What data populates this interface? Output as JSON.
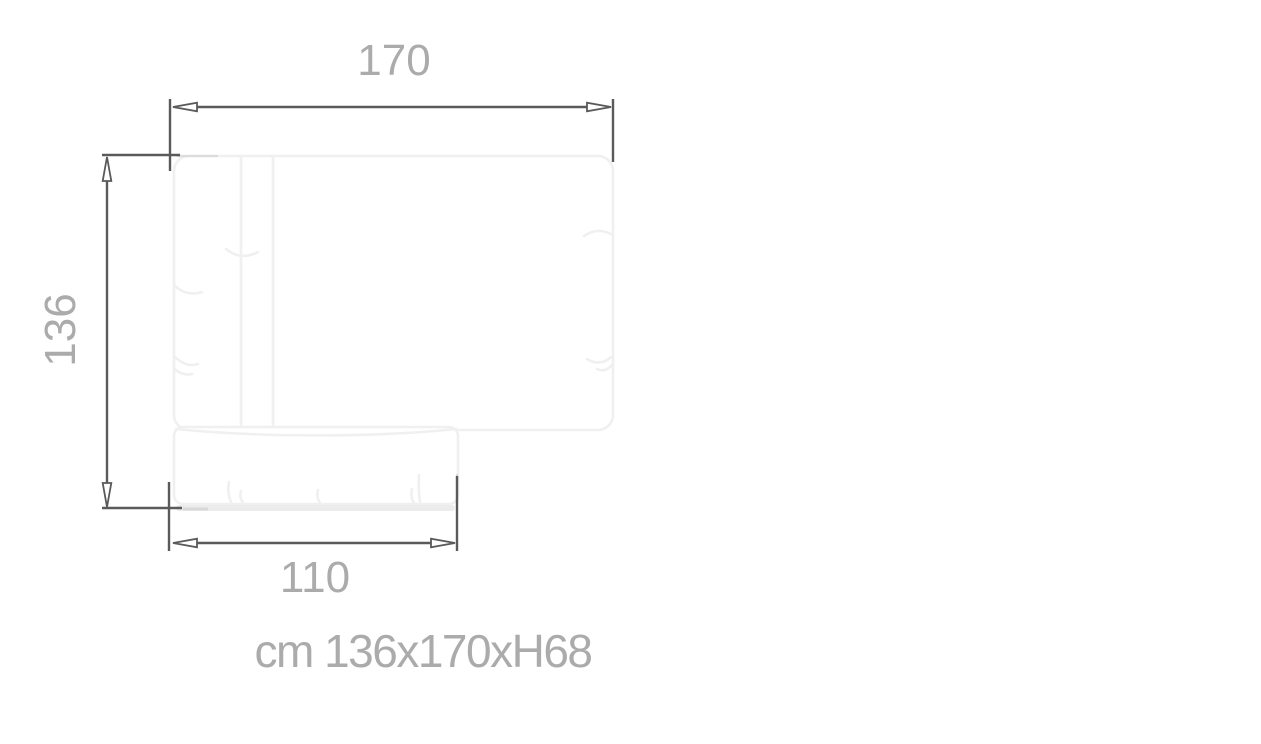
{
  "drawing": {
    "subject": "sofa-with-chaise-top-view-dimension-diagram",
    "unit": "cm",
    "labels": {
      "width": "170",
      "depth": "136",
      "chaise_width": "110"
    },
    "caption": "cm 136x170xH68",
    "colors": {
      "dimension_line": "#5a5a5a",
      "label_text": "#ababab",
      "furniture_outline": "#f0f0f0",
      "furniture_shadow": "#ececec",
      "background": "#ffffff"
    }
  }
}
